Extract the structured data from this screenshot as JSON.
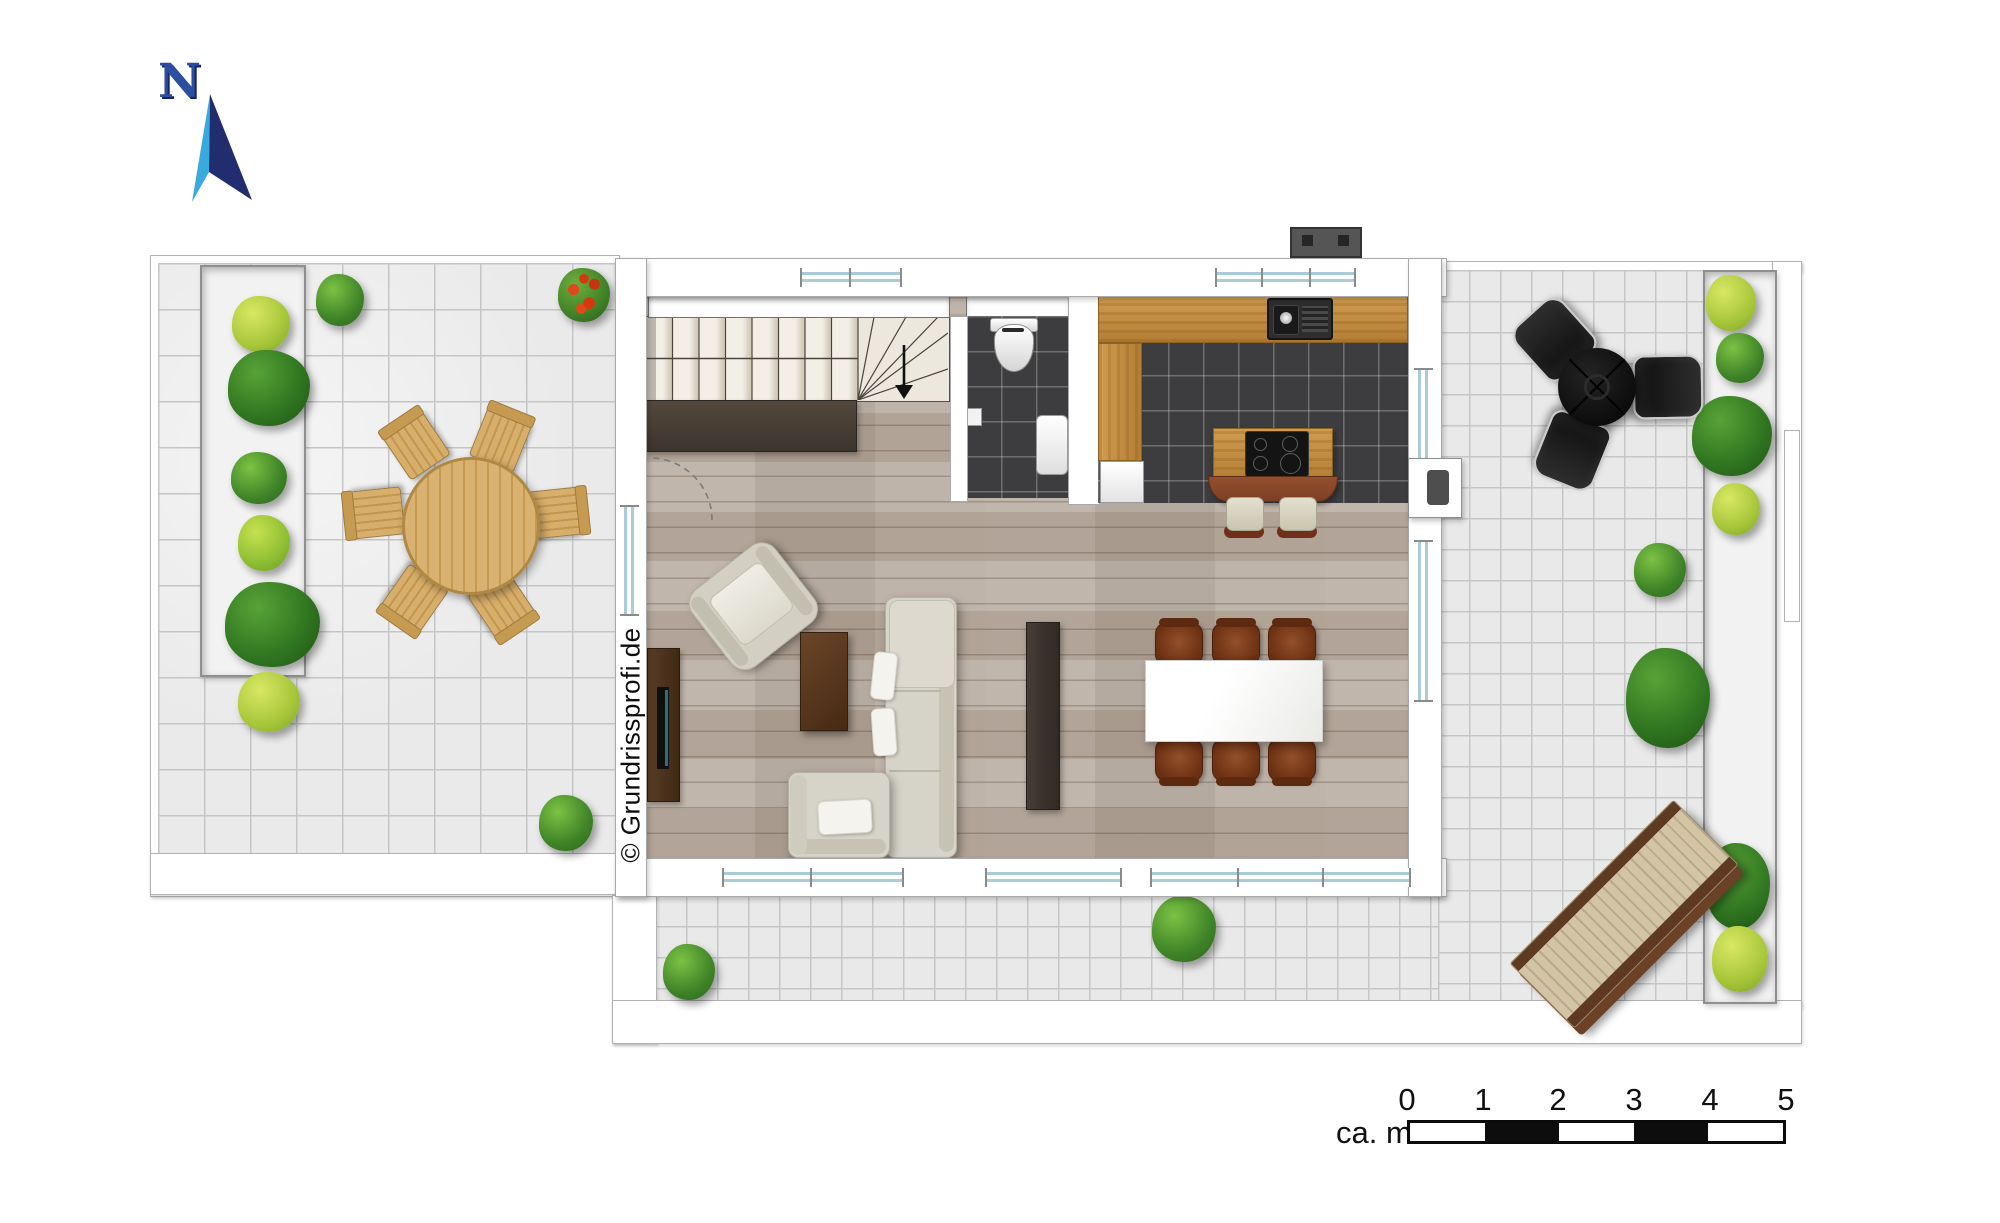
{
  "north": {
    "label": "N"
  },
  "watermark": {
    "text": "© Grundrissprofi.de"
  },
  "scale_bar": {
    "label": "ca. m.",
    "ticks": [
      "0",
      "1",
      "2",
      "3",
      "4",
      "5"
    ],
    "segments": 5,
    "unit_meters_per_segment": 1
  },
  "colors": {
    "background": "#ffffff",
    "wall": "#ffffff",
    "wall_outline": "#a9a9a9",
    "terrace_tile": "#e9e9e9",
    "tile_line": "#c6c6c6",
    "wood_floor": "#b6a99d",
    "dark_tile": "#3d3d3f",
    "counter_wood": "#c28c42",
    "bar_brown": "#7d4024",
    "sofa_cream": "#d6d3c8",
    "dining_chair_brown": "#7c3c1e",
    "black_patio_set": "#161616",
    "plant_green": "#4e9431",
    "plant_light_green": "#a7c63a",
    "plant_red_flowers": "#d43a12",
    "window_blue": "#a9ccd6",
    "north_cyan": "#39a9de",
    "north_navy": "#212d6e"
  },
  "symbols": {
    "north-arrow-icon": "two-tone compass needle pointing north",
    "stair-down-arrow-icon": "black arrow showing stair direction",
    "door-swing-icon": "dashed quarter-circle door swing",
    "toilet-icon": "white wc seen from above",
    "washbasin-icon": "white basin rectangle",
    "kitchen-sink-icon": "dark sink with drainboard",
    "cooktop-icon": "black hob with four burners",
    "tv-icon": "flat tv on sideboard"
  }
}
